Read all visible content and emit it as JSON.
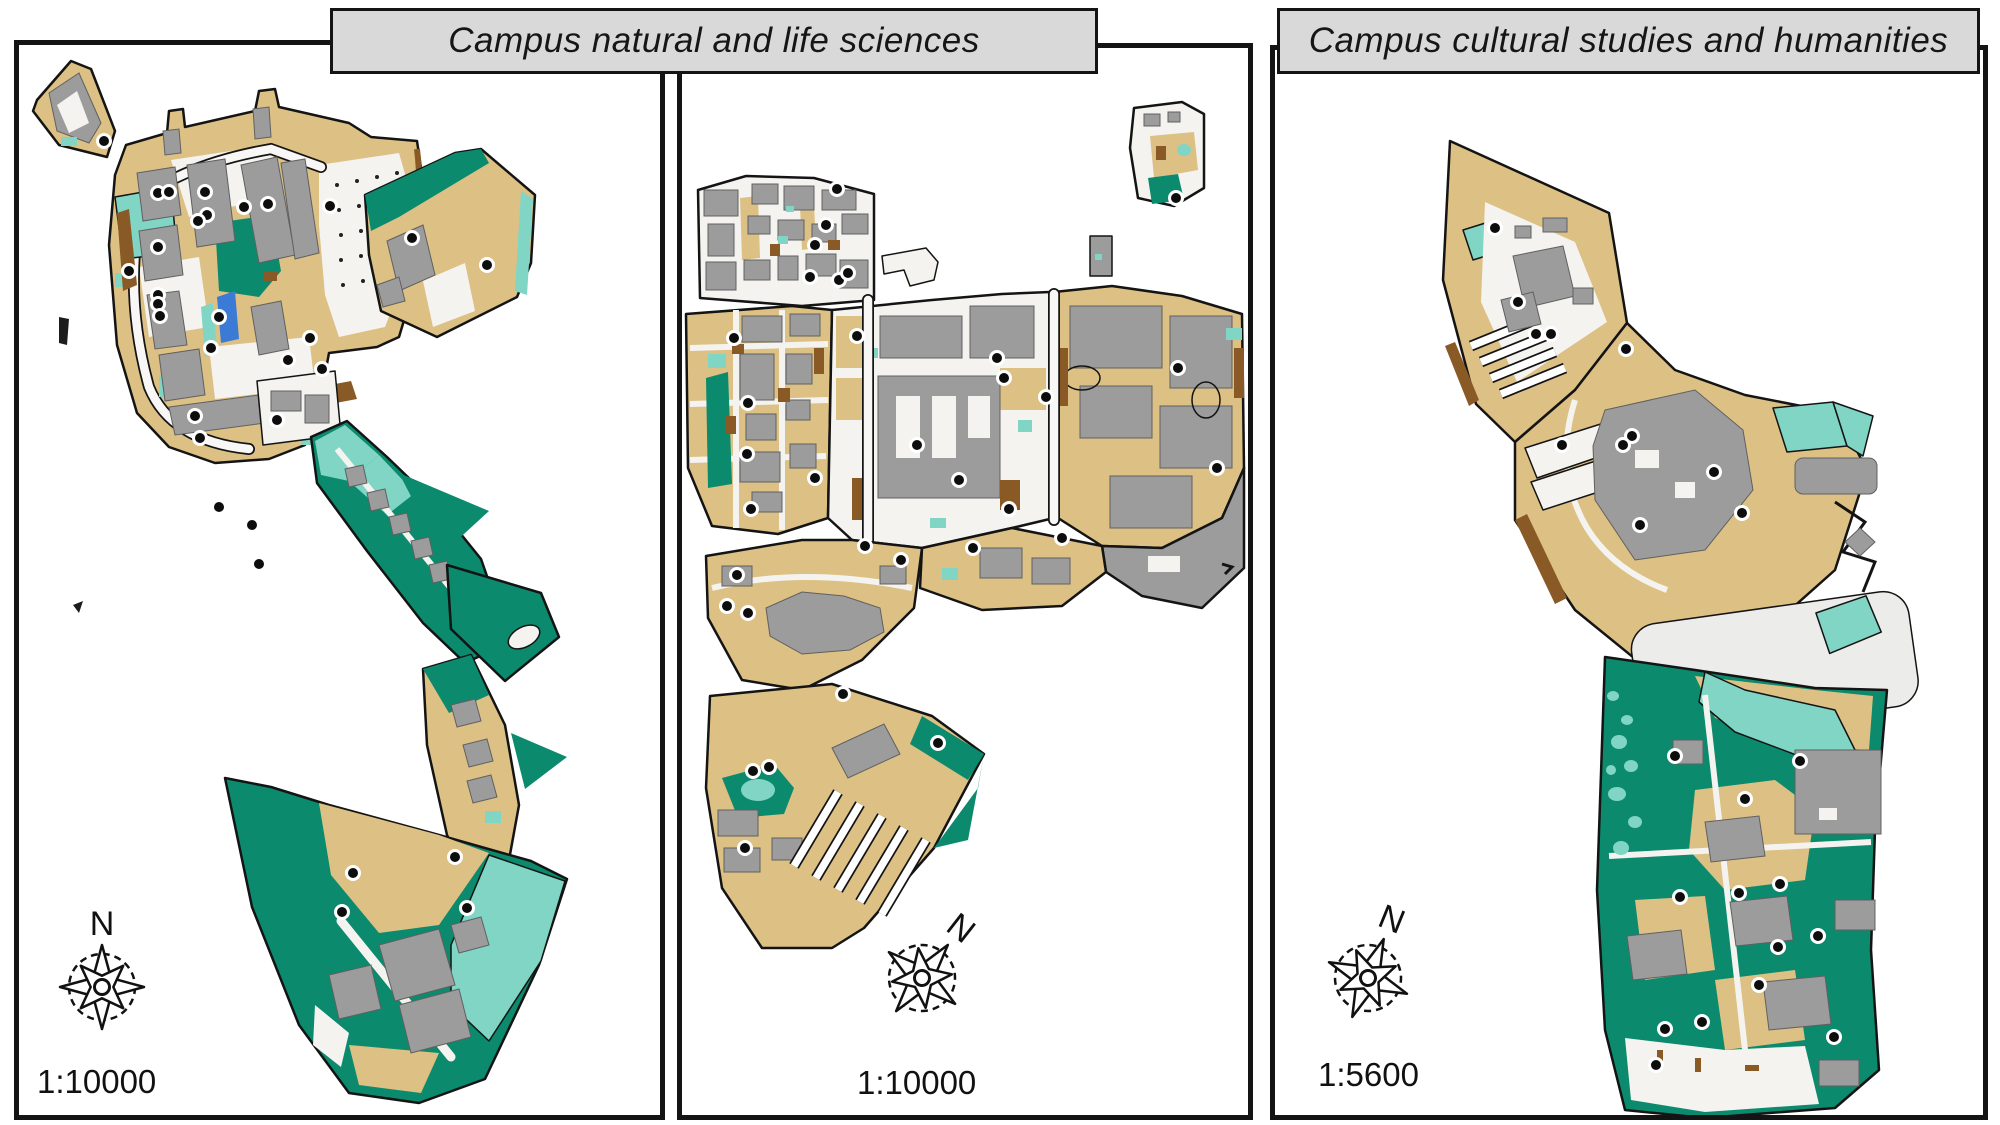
{
  "figure": {
    "type": "map-figure",
    "description": "Three campus land-use maps with compass roses and scale labels"
  },
  "group_titles": [
    {
      "label": "Campus natural and life sciences"
    },
    {
      "label": "Campus cultural studies and humanities"
    }
  ],
  "palette": {
    "ground": "#ddc084",
    "forest": "#0b8a6d",
    "lawn": "#80d5c4",
    "water": "#3b7bd6",
    "building": "#9c9c9c",
    "bstroke": "#606060",
    "soil": "#8a5a26",
    "path": "#f4f3f0",
    "plaza": "#ececea",
    "outline": "#141414",
    "titlebg": "#d9d9d9",
    "ink": "#111111"
  },
  "panels": [
    {
      "id": "left",
      "scale_label": "1:10000",
      "compass_label": "N",
      "compass_rotation_deg": 0,
      "markers": [
        [
          85,
          96
        ],
        [
          139,
          148
        ],
        [
          150,
          147
        ],
        [
          186,
          147
        ],
        [
          225,
          162
        ],
        [
          249,
          159
        ],
        [
          311,
          161
        ],
        [
          188,
          170
        ],
        [
          179,
          176
        ],
        [
          139,
          202
        ],
        [
          110,
          226
        ],
        [
          139,
          250
        ],
        [
          139,
          259
        ],
        [
          141,
          271
        ],
        [
          200,
          272
        ],
        [
          192,
          303
        ],
        [
          291,
          293
        ],
        [
          269,
          315
        ],
        [
          303,
          324
        ],
        [
          393,
          193
        ],
        [
          468,
          220
        ],
        [
          176,
          371
        ],
        [
          258,
          375
        ],
        [
          181,
          393
        ],
        [
          200,
          462
        ],
        [
          233,
          480
        ],
        [
          240,
          519
        ],
        [
          436,
          812
        ],
        [
          334,
          828
        ],
        [
          323,
          867
        ],
        [
          448,
          863
        ]
      ]
    },
    {
      "id": "middle",
      "scale_label": "1:10000",
      "compass_label": "N",
      "compass_rotation_deg": 38,
      "markers": [
        [
          494,
          150
        ],
        [
          155,
          141
        ],
        [
          144,
          177
        ],
        [
          133,
          197
        ],
        [
          128,
          229
        ],
        [
          157,
          232
        ],
        [
          166,
          225
        ],
        [
          52,
          290
        ],
        [
          66,
          355
        ],
        [
          65,
          406
        ],
        [
          133,
          430
        ],
        [
          69,
          461
        ],
        [
          175,
          288
        ],
        [
          315,
          310
        ],
        [
          322,
          330
        ],
        [
          364,
          349
        ],
        [
          235,
          397
        ],
        [
          496,
          320
        ],
        [
          535,
          420
        ],
        [
          380,
          490
        ],
        [
          277,
          432
        ],
        [
          327,
          461
        ],
        [
          291,
          500
        ],
        [
          183,
          498
        ],
        [
          219,
          512
        ],
        [
          55,
          527
        ],
        [
          45,
          558
        ],
        [
          66,
          565
        ],
        [
          161,
          646
        ],
        [
          256,
          695
        ],
        [
          71,
          723
        ],
        [
          87,
          719
        ],
        [
          63,
          800
        ]
      ]
    },
    {
      "id": "right",
      "scale_label": "1:5600",
      "compass_label": "N",
      "compass_rotation_deg": 22,
      "markers": [
        [
          220,
          178
        ],
        [
          243,
          252
        ],
        [
          261,
          284
        ],
        [
          276,
          284
        ],
        [
          351,
          299
        ],
        [
          357,
          386
        ],
        [
          348,
          395
        ],
        [
          287,
          395
        ],
        [
          439,
          422
        ],
        [
          467,
          463
        ],
        [
          365,
          475
        ],
        [
          400,
          706
        ],
        [
          525,
          711
        ],
        [
          470,
          749
        ],
        [
          405,
          847
        ],
        [
          464,
          843
        ],
        [
          505,
          834
        ],
        [
          543,
          886
        ],
        [
          503,
          897
        ],
        [
          484,
          935
        ],
        [
          427,
          972
        ],
        [
          390,
          979
        ],
        [
          559,
          987
        ],
        [
          381,
          1015
        ]
      ]
    }
  ]
}
